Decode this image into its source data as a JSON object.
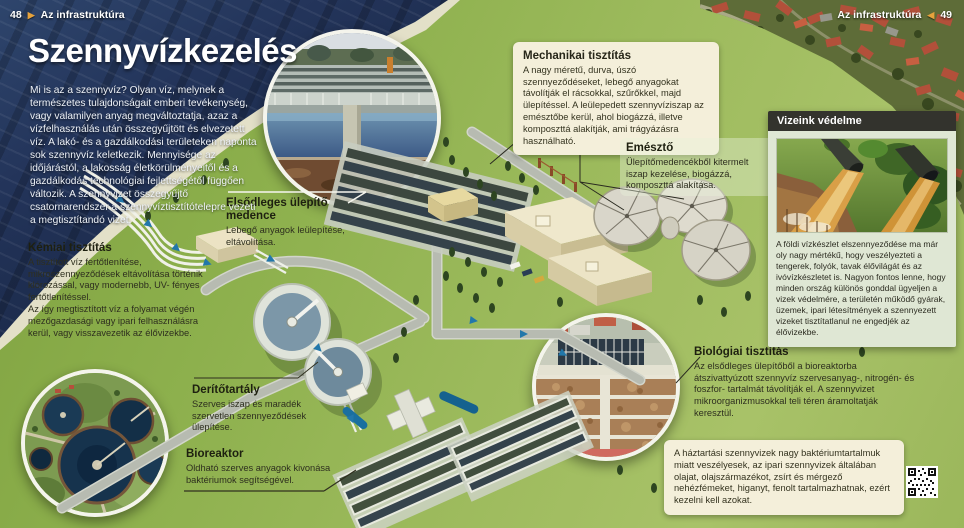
{
  "page_header_left": {
    "page_number": "48",
    "section": "Az infrastruktúra",
    "marker": "▶"
  },
  "page_header_right": {
    "page_number": "49",
    "section": "Az infrastruktúra",
    "marker": "◀"
  },
  "title": "Szennyvízkezelés",
  "intro": "Mi is az a szennyvíz? Olyan víz, melynek a természetes tulajdonságait emberi tevékenység, vagy valamilyen anyag megváltoztatja, azaz a vízfelhasználás után összegyűjtött és elvezetett víz. A lakó- és a gazdálkodási területeken naponta sok szennyvíz keletkezik. Mennyisége az időjárástól, a lakosság életkörülményeitől és a gazdálkodás technológiai fejlettségétől függően változik. A szennyvizet összegyűjtő csatornarendszer a szennyvíztisztítótelepre vezeti a megtisztítandó vizet.",
  "callouts": {
    "mechanikai": {
      "title": "Mechanikai tisztítás",
      "body": "A nagy méretű, durva, úszó szennyeződéseket, lebegő anyagokat távolítják el rácsokkal, szűrőkkel, majd ülepítéssel. A leülepedett szennyvíziszap az emésztőbe kerül, ahol biogázzá, illetve komposzttá alakítják, ami trágyázásra használható."
    },
    "emeszto": {
      "title": "Emésztő",
      "body": "Ülepítőmedencékből kitermelt iszap kezelése, biogázzá, komposzttá alakítása."
    },
    "elsodleges": {
      "title": "Elsődleges ülepítő medence",
      "body": "Lebegő anyagok leülepítése, eltávolítása."
    },
    "kemiai": {
      "title": "Kémiai tisztítás",
      "body": "A tisztított víz fertőtlenítése, mikroszennyeződések eltávolítása történik klórozással, vagy modernebb, UV- fényes fertőtlenítéssel.\nAz így megtisztított víz a folyamat végén mezőgazdasági vagy ipari felhasználásra kerül, vagy visszavezetik az élővizekbe."
    },
    "derito": {
      "title": "Derítőtartály",
      "body": "Szerves iszap és maradék szervetlen szennyeződések ülepítése."
    },
    "bioreaktor": {
      "title": "Bioreaktor",
      "body": "Oldható szerves anyagok kivonása baktériumok segítségével."
    },
    "biologiai": {
      "title": "Biológiai tisztítás",
      "body": "Az elsődleges ülepítőből a bioreaktorba átszivattyúzott szennyvíz szervesanyag-, nitrogén- és foszfor- tartalmát távolítják el. A szennyvizet mikroorganizmusokkal teli téren áramoltatják keresztül."
    }
  },
  "sidebar": {
    "title": "Vizeink védelme",
    "body": "A földi vízkészlet elszennyeződése ma már oly nagy mértékű, hogy veszélyezteti a tengerek, folyók, tavak élővilágát és az ivóvízkészletet is. Nagyon fontos lenne, hogy minden ország különös gonddal ügyeljen a vizek védelmére, a területén működő gyárak, üzemek, ipari létesítmények a szennyezett vizeket tisztítatlanul ne engedjék az élővizekbe."
  },
  "note_box": {
    "body": "A háztartási szennyvizek nagy baktériumtartalmuk miatt veszélyesek, az ipari szennyvizek általában olajat, olajszármazékot, zsírt és mérgező nehézfémeket, higanyt, fenolt tartalmazhatnak, ezért kezelni kell azokat."
  },
  "colors": {
    "accent_orange": "#e6a23c",
    "water_navy": "#1e3152",
    "grass_green": "#8fb050",
    "callout_cream": "#f4efda",
    "panel_header_dark": "#33332d",
    "panel_body": "#dfe7d4"
  }
}
